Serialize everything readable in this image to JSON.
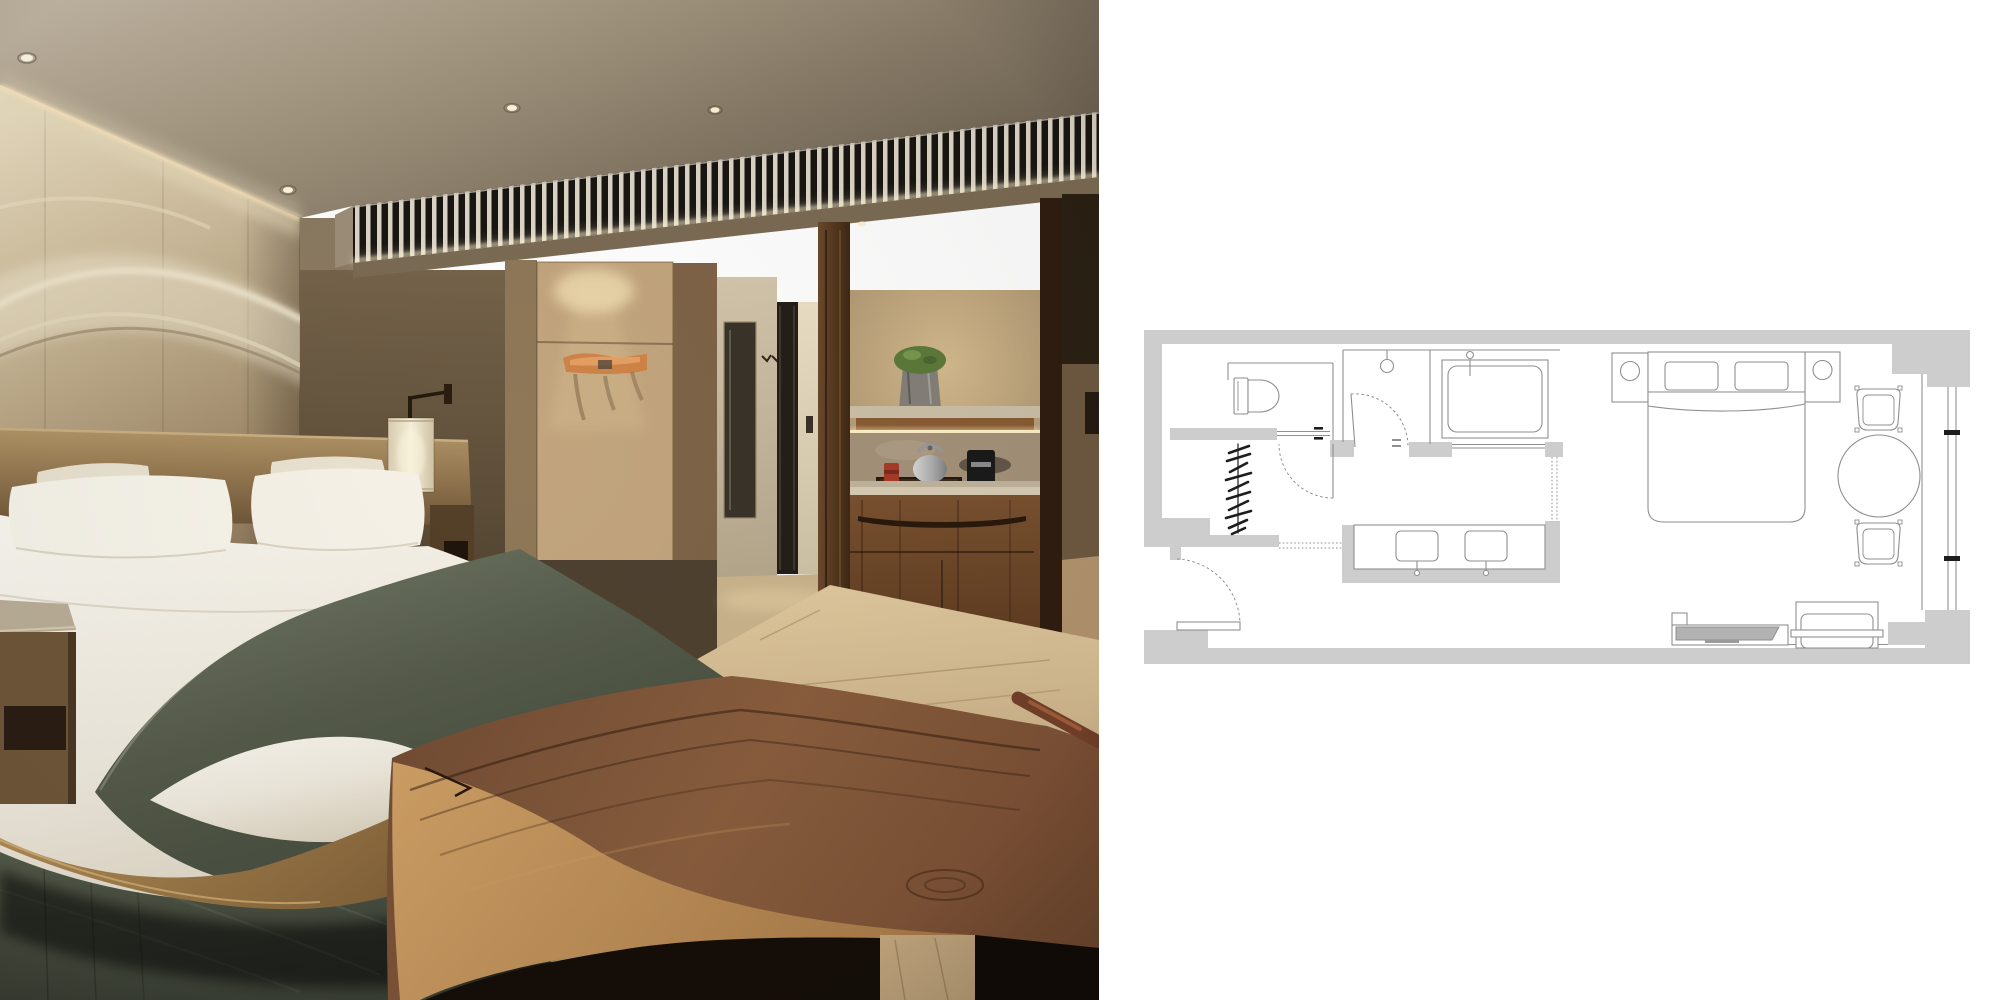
{
  "meta": {
    "width": 2000,
    "height": 1000,
    "photo_label": "Photograph of a hotel guest room with king bed, green throw blanket, backlit slatted wood cornice, wardrobe, marble bathroom corridor and walnut minibar cabinet",
    "plan_label": "Gray line-art floor plan of the same guest room showing toilet, closet, shower, bathtub, double vanity, bedroom with king bed, round table with two chairs, desk and TV console along a window wall"
  },
  "photo": {
    "scene": "hotel-guest-room",
    "elements": [
      "ceiling-downlights",
      "cove-lighting",
      "plaster-wave-artwork",
      "headboard-wall",
      "slatted-wood-screen",
      "king-bed",
      "white-pillows",
      "white-duvet",
      "sage-green-throw",
      "leather-headboard",
      "wall-mounted-lamp",
      "stone-top-nightstand",
      "wardrobe-panel",
      "driftwood-coat-rack",
      "bathroom-corridor",
      "glass-shower-door",
      "minibar-niche",
      "stone-counter",
      "tea-kettle",
      "espresso-machine",
      "red-tea-caddy",
      "potted-moss-plant",
      "walnut-cabinet",
      "oak-floor",
      "green-area-rug",
      "live-edge-wood-table"
    ],
    "colors": {
      "ceiling": "#a2957f",
      "wall_beige": "#cdbc9c",
      "cove_glow": "#f5e8c8",
      "linen_white": "#f7f4ea",
      "throw_green": "#555b4a",
      "rug_green": "#4c5446",
      "walnut": "#6a4426",
      "oak_floor": "#c9b28c",
      "slat_light": "#ddd6c8",
      "slat_dark": "#191510"
    }
  },
  "floor_plan": {
    "colors": {
      "wall": "#cdcdcd",
      "line": "#8f8f8f",
      "dark": "#1d1d1d",
      "tv": "#b2b2b2",
      "background": "#ffffff"
    },
    "rooms": [
      "toilet-room",
      "closet",
      "shower-room",
      "bath-room",
      "vanity-corridor",
      "entry",
      "bedroom",
      "window-bay"
    ],
    "fixtures": [
      "toilet",
      "clothes-hanger-hatching",
      "shower-head",
      "bathtub",
      "double-sink-vanity",
      "entry-door-swing",
      "hall-door-swing",
      "bathroom-door-swing",
      "sliding-door",
      "king-bed",
      "pillows",
      "nightstand-left",
      "nightstand-right",
      "table-lamps",
      "round-table",
      "dining-chair-top",
      "dining-chair-bottom",
      "desk",
      "desk-chair",
      "tv-console",
      "television",
      "window-mullions"
    ]
  }
}
